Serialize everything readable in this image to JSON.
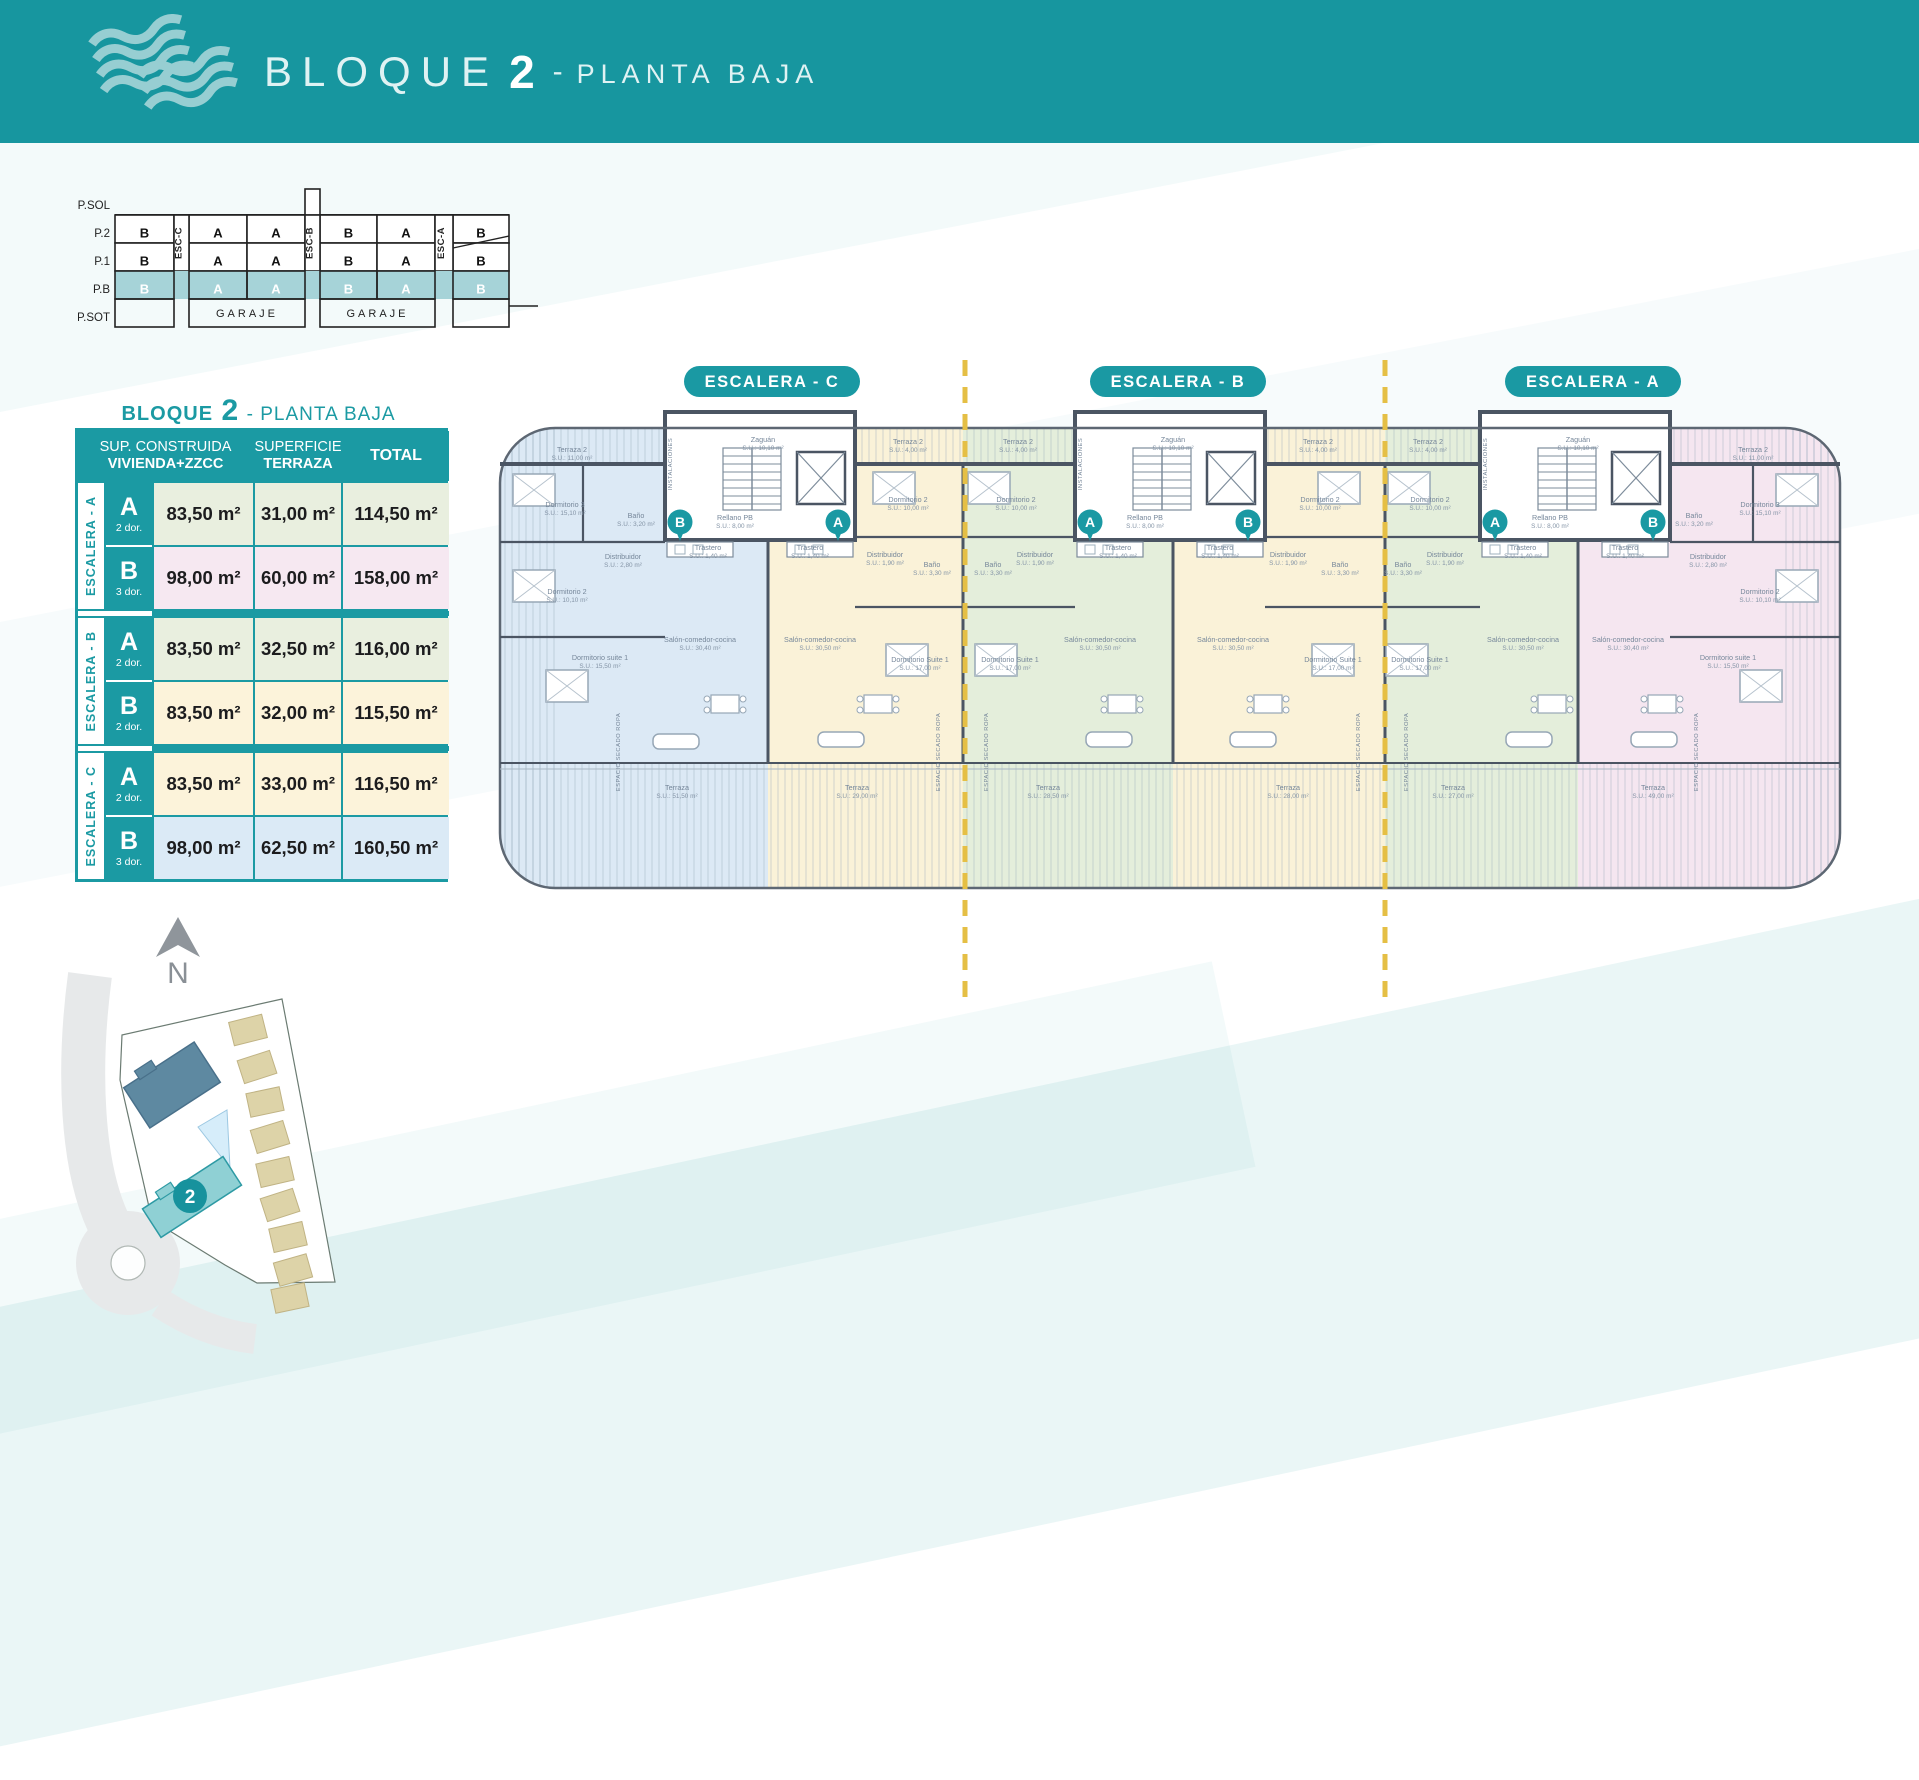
{
  "header": {
    "title_block": "BLOQUE",
    "title_number": "2",
    "separator": "-",
    "title_floor": "PLANTA BAJA"
  },
  "stack": {
    "floors": [
      "P.SOL",
      "P.2",
      "P.1",
      "P.B",
      "P.SOT"
    ],
    "esc_labels": [
      "ESC-C",
      "ESC-B",
      "ESC-A"
    ],
    "rows": {
      "p2": [
        "B",
        "A",
        "A",
        "B",
        "A",
        "B"
      ],
      "p1": [
        "B",
        "A",
        "A",
        "B",
        "A",
        "B"
      ],
      "pb": [
        "B",
        "A",
        "A",
        "B",
        "A",
        "B"
      ]
    },
    "garaje": [
      "GARAJE",
      "GARAJE"
    ]
  },
  "table": {
    "title_pre": "BLOQUE",
    "title_num": "2",
    "title_post": "- PLANTA BAJA",
    "headers": {
      "col1_line1": "SUP. CONSTRUIDA",
      "col1_line2": "VIVIENDA+ZZCC",
      "col2_line1": "SUPERFICIE",
      "col2_line2": "TERRAZA",
      "col3": "TOTAL"
    },
    "groups": [
      {
        "label": "ESCALERA - A",
        "rows": [
          {
            "type": "A",
            "dor": "2 dor.",
            "sup": "83,50 m²",
            "terraza": "31,00 m²",
            "total": "114,50 m²",
            "color": "#e9efdf"
          },
          {
            "type": "B",
            "dor": "3 dor.",
            "sup": "98,00 m²",
            "terraza": "60,00 m²",
            "total": "158,00 m²",
            "color": "#f6e8f1"
          }
        ]
      },
      {
        "label": "ESCALERA - B",
        "rows": [
          {
            "type": "A",
            "dor": "2 dor.",
            "sup": "83,50 m²",
            "terraza": "32,50 m²",
            "total": "116,00 m²",
            "color": "#e9efdf"
          },
          {
            "type": "B",
            "dor": "2 dor.",
            "sup": "83,50 m²",
            "terraza": "32,00 m²",
            "total": "115,50 m²",
            "color": "#fcf3da"
          }
        ]
      },
      {
        "label": "ESCALERA - C",
        "rows": [
          {
            "type": "A",
            "dor": "2 dor.",
            "sup": "83,50 m²",
            "terraza": "33,00 m²",
            "total": "116,50 m²",
            "color": "#fcf3da"
          },
          {
            "type": "B",
            "dor": "3 dor.",
            "sup": "98,00 m²",
            "terraza": "62,50 m²",
            "total": "160,50 m²",
            "color": "#dbeaf6"
          }
        ]
      }
    ]
  },
  "plan": {
    "pills": [
      {
        "x": 284,
        "label": "ESCALERA - C"
      },
      {
        "x": 690,
        "label": "ESCALERA - B"
      },
      {
        "x": 1105,
        "label": "ESCALERA - A"
      }
    ],
    "badges": [
      {
        "x": 192,
        "y": 170,
        "t": "B"
      },
      {
        "x": 350,
        "y": 170,
        "t": "A"
      },
      {
        "x": 602,
        "y": 170,
        "t": "A"
      },
      {
        "x": 760,
        "y": 170,
        "t": "B"
      },
      {
        "x": 1007,
        "y": 170,
        "t": "A"
      },
      {
        "x": 1165,
        "y": 170,
        "t": "B"
      }
    ],
    "labels": [
      {
        "x": 84,
        "y": 100,
        "t": "Terraza 2",
        "s": "S.U.: 11,00 m²"
      },
      {
        "x": 77,
        "y": 155,
        "t": "Dormitorio 3",
        "s": "S.U.: 15,10 m²"
      },
      {
        "x": 148,
        "y": 166,
        "t": "Baño",
        "s": "S.U.: 3,20 m²"
      },
      {
        "x": 135,
        "y": 207,
        "t": "Distribuidor",
        "s": "S.U.: 2,80 m²"
      },
      {
        "x": 79,
        "y": 242,
        "t": "Dormitorio 2",
        "s": "S.U.: 10,10 m²"
      },
      {
        "x": 112,
        "y": 308,
        "t": "Dormitorio suite 1",
        "s": "S.U.: 15,50 m²"
      },
      {
        "x": 212,
        "y": 290,
        "t": "Salón-comedor-cocina",
        "s": "S.U.: 30,40 m²"
      },
      {
        "x": 189,
        "y": 438,
        "t": "Terraza",
        "s": "S.U.: 51,50 m²"
      },
      {
        "x": 420,
        "y": 92,
        "t": "Terraza 2",
        "s": "S.U.: 4,00 m²"
      },
      {
        "x": 420,
        "y": 150,
        "t": "Dormitorio 2",
        "s": "S.U.: 10,00 m²"
      },
      {
        "x": 397,
        "y": 205,
        "t": "Distribuidor",
        "s": "S.U.: 1,90 m²"
      },
      {
        "x": 444,
        "y": 215,
        "t": "Baño",
        "s": "S.U.: 3,30 m²"
      },
      {
        "x": 432,
        "y": 310,
        "t": "Dormitorio Suite 1",
        "s": "S.U.: 17,00 m²"
      },
      {
        "x": 332,
        "y": 290,
        "t": "Salón-comedor-cocina",
        "s": "S.U.: 30,50 m²"
      },
      {
        "x": 369,
        "y": 438,
        "t": "Terraza",
        "s": "S.U.: 29,00 m²"
      },
      {
        "x": 275,
        "y": 90,
        "t": "Zaguán",
        "s": "S.U.: 10,10 m²"
      },
      {
        "x": 247,
        "y": 168,
        "t": "Rellano PB",
        "s": "S.U.: 8,00 m²"
      },
      {
        "x": 220,
        "y": 198,
        "t": "Trastero",
        "s": "S.U.: 1,40 m²"
      },
      {
        "x": 322,
        "y": 198,
        "t": "Trastero",
        "s": "S.U.: 1,40 m²"
      },
      {
        "x": 184,
        "y": 112,
        "t": "INSTALACIONES",
        "r": -90
      },
      {
        "x": 530,
        "y": 92,
        "t": "Terraza 2",
        "s": "S.U.: 4,00 m²"
      },
      {
        "x": 528,
        "y": 150,
        "t": "Dormitorio 2",
        "s": "S.U.: 10,00 m²"
      },
      {
        "x": 505,
        "y": 215,
        "t": "Baño",
        "s": "S.U.: 3,30 m²"
      },
      {
        "x": 547,
        "y": 205,
        "t": "Distribuidor",
        "s": "S.U.: 1,90 m²"
      },
      {
        "x": 522,
        "y": 310,
        "t": "Dormitorio Suite 1",
        "s": "S.U.: 17,00 m²"
      },
      {
        "x": 612,
        "y": 290,
        "t": "Salón-comedor-cocina",
        "s": "S.U.: 30,50 m²"
      },
      {
        "x": 560,
        "y": 438,
        "t": "Terraza",
        "s": "S.U.: 28,50 m²"
      },
      {
        "x": 830,
        "y": 92,
        "t": "Terraza 2",
        "s": "S.U.: 4,00 m²"
      },
      {
        "x": 832,
        "y": 150,
        "t": "Dormitorio 2",
        "s": "S.U.: 10,00 m²"
      },
      {
        "x": 800,
        "y": 205,
        "t": "Distribuidor",
        "s": "S.U.: 1,90 m²"
      },
      {
        "x": 852,
        "y": 215,
        "t": "Baño",
        "s": "S.U.: 3,30 m²"
      },
      {
        "x": 845,
        "y": 310,
        "t": "Dormitorio Suite 1",
        "s": "S.U.: 17,00 m²"
      },
      {
        "x": 745,
        "y": 290,
        "t": "Salón-comedor-cocina",
        "s": "S.U.: 30,50 m²"
      },
      {
        "x": 800,
        "y": 438,
        "t": "Terraza",
        "s": "S.U.: 28,00 m²"
      },
      {
        "x": 685,
        "y": 90,
        "t": "Zaguán",
        "s": "S.U.: 10,10 m²"
      },
      {
        "x": 657,
        "y": 168,
        "t": "Rellano PB",
        "s": "S.U.: 8,00 m²"
      },
      {
        "x": 630,
        "y": 198,
        "t": "Trastero",
        "s": "S.U.: 1,40 m²"
      },
      {
        "x": 732,
        "y": 198,
        "t": "Trastero",
        "s": "S.U.: 1,40 m²"
      },
      {
        "x": 594,
        "y": 112,
        "t": "INSTALACIONES",
        "r": -90
      },
      {
        "x": 940,
        "y": 92,
        "t": "Terraza 2",
        "s": "S.U.: 4,00 m²"
      },
      {
        "x": 942,
        "y": 150,
        "t": "Dormitorio 2",
        "s": "S.U.: 10,00 m²"
      },
      {
        "x": 915,
        "y": 215,
        "t": "Baño",
        "s": "S.U.: 3,30 m²"
      },
      {
        "x": 957,
        "y": 205,
        "t": "Distribuidor",
        "s": "S.U.: 1,90 m²"
      },
      {
        "x": 932,
        "y": 310,
        "t": "Dormitorio Suite 1",
        "s": "S.U.: 17,00 m²"
      },
      {
        "x": 1035,
        "y": 290,
        "t": "Salón-comedor-cocina",
        "s": "S.U.: 30,50 m²"
      },
      {
        "x": 965,
        "y": 438,
        "t": "Terraza",
        "s": "S.U.: 27,00 m²"
      },
      {
        "x": 1265,
        "y": 100,
        "t": "Terraza 2",
        "s": "S.U.: 11,00 m²"
      },
      {
        "x": 1272,
        "y": 155,
        "t": "Dormitorio 3",
        "s": "S.U.: 15,10 m²"
      },
      {
        "x": 1206,
        "y": 166,
        "t": "Baño",
        "s": "S.U.: 3,20 m²"
      },
      {
        "x": 1220,
        "y": 207,
        "t": "Distribuidor",
        "s": "S.U.: 2,80 m²"
      },
      {
        "x": 1272,
        "y": 242,
        "t": "Dormitorio 2",
        "s": "S.U.: 10,10 m²"
      },
      {
        "x": 1240,
        "y": 308,
        "t": "Dormitorio suite 1",
        "s": "S.U.: 15,50 m²"
      },
      {
        "x": 1140,
        "y": 290,
        "t": "Salón-comedor-cocina",
        "s": "S.U.: 30,40 m²"
      },
      {
        "x": 1165,
        "y": 438,
        "t": "Terraza",
        "s": "S.U.: 49,00 m²"
      },
      {
        "x": 1090,
        "y": 90,
        "t": "Zaguán",
        "s": "S.U.: 10,10 m²"
      },
      {
        "x": 1062,
        "y": 168,
        "t": "Rellano PB",
        "s": "S.U.: 8,00 m²"
      },
      {
        "x": 1035,
        "y": 198,
        "t": "Trastero",
        "s": "S.U.: 1,40 m²"
      },
      {
        "x": 1137,
        "y": 198,
        "t": "Trastero",
        "s": "S.U.: 1,40 m²"
      },
      {
        "x": 999,
        "y": 112,
        "t": "INSTALACIONES",
        "r": -90
      },
      {
        "x": 132,
        "y": 400,
        "t": "ESPACIO SECADO ROPA",
        "r": -90
      },
      {
        "x": 452,
        "y": 400,
        "t": "ESPACIO SECADO ROPA",
        "r": -90
      },
      {
        "x": 500,
        "y": 400,
        "t": "ESPACIO SECADO ROPA",
        "r": -90
      },
      {
        "x": 872,
        "y": 400,
        "t": "ESPACIO SECADO ROPA",
        "r": -90
      },
      {
        "x": 920,
        "y": 400,
        "t": "ESPACIO SECADO ROPA",
        "r": -90
      },
      {
        "x": 1210,
        "y": 400,
        "t": "ESPACIO SECADO ROPA",
        "r": -90
      }
    ]
  },
  "sitemap": {
    "north_label": "N",
    "block_badge": "2"
  },
  "colors": {
    "teal": "#17969f",
    "table_teal": "#1b9aa3",
    "row_green": "#e9efdf",
    "row_pink": "#f6e8f1",
    "row_cream": "#fcf3da",
    "row_blue": "#dbeaf6",
    "plan_blue": "#dce9f5",
    "plan_cream": "#faf2d8",
    "plan_green": "#e4eedb",
    "plan_pink": "#f5e6f0",
    "wall": "#4b5563",
    "dash_gold": "#e5bf45",
    "site_block1": "#5e89a1",
    "site_block2": "#8fd0d4",
    "site_houses": "#ddd3a8"
  }
}
